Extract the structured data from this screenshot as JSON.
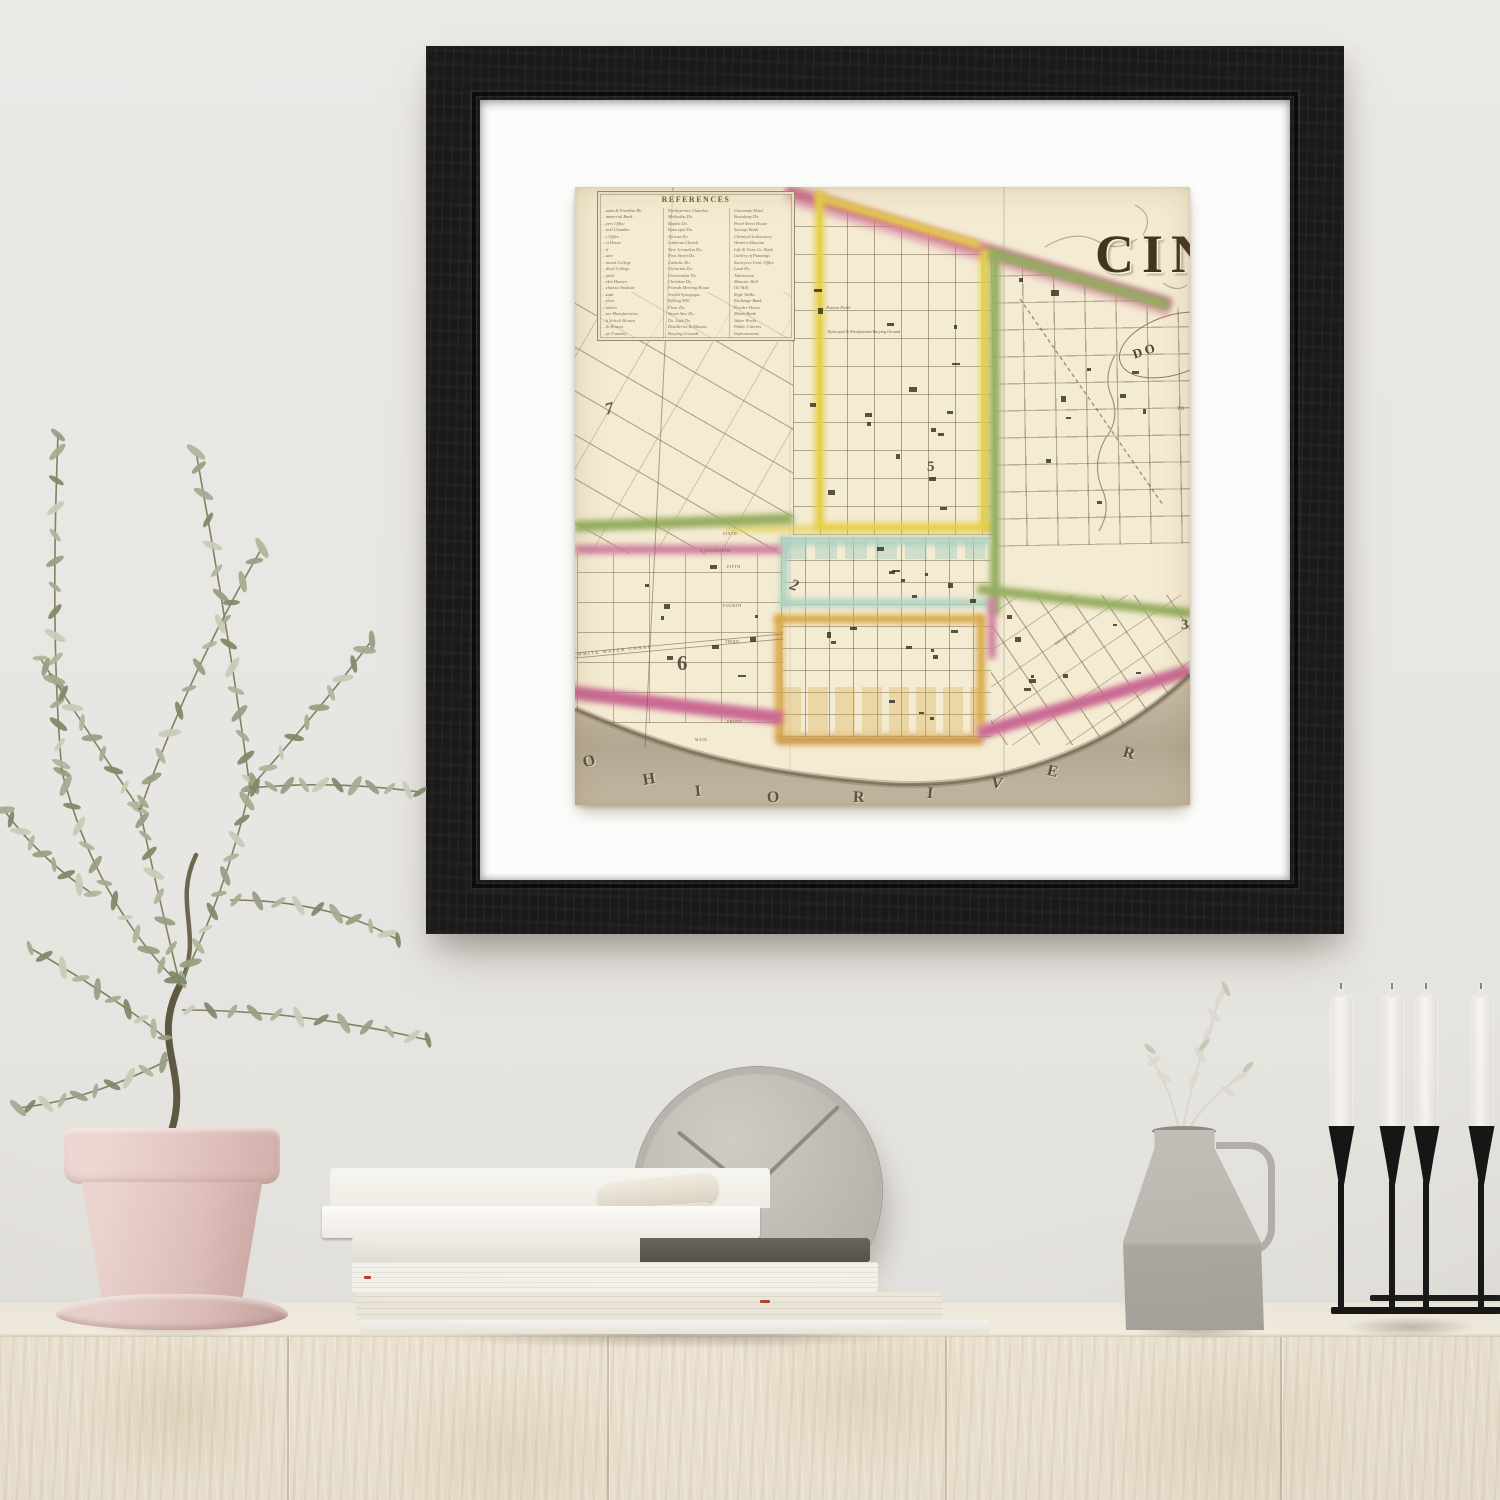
{
  "scene": {
    "objects": [
      "framed-map-print",
      "olive-plant-in-pot",
      "book-stack",
      "wall-clock",
      "jug-vase",
      "candle-stand",
      "wood-sideboard"
    ]
  },
  "artwork": {
    "title_partial": "CIN",
    "legend": {
      "title": "REFERENCES",
      "col1": [
        "…ands & Franklin Bk.",
        "…mmercial Bank",
        "…yers Office",
        "…ncil Chamber",
        "…t Office",
        "…rt House",
        "…il",
        "…atre",
        "…innati College",
        "…dical College",
        "…pital",
        "…rket Houses",
        "…chanics Institute",
        "…zaar",
        "…eries",
        "…ndries",
        "…ine Manufactories",
        "…h School Houses",
        "…th Houses",
        "…pe Foundry"
      ],
      "col2": [
        "Presbyterian Churches",
        "Methodist Do.",
        "Baptist Do.",
        "Episcopal Do.",
        "African Do.",
        "Lutheran Church",
        "New Jerusalem Do.",
        "First Street Do.",
        "Catholic Do.",
        "Unitarian Do.",
        "Universalist Do.",
        "Christian Do.",
        "Friends Meeting House",
        "Jewish Synagogue",
        "Rolling Mill",
        "Flour Do.",
        "Steam Saw Do.",
        "Do. Lath Do.",
        "Distilleries & Masons",
        "Burying Grounds"
      ],
      "col3": [
        "Cincinnati Hotel",
        "Broadway Do.",
        "Pearl Street House",
        "Savings Bank",
        "Chemical Laboratory",
        "Western Museum",
        "Life & Trust Co. Bank",
        "Gallery of Paintings",
        "Surveyors Genl. Office",
        "Land Do.",
        "Athenaeum",
        "Masonic Hall",
        "Oil Mill",
        "Rope Walks",
        "Exchange Bank",
        "Powder House",
        "Miami Bank",
        "Water Works",
        "Public Cisterns",
        "Improvements"
      ]
    },
    "river": [
      "O",
      "H",
      "I",
      "O",
      "R",
      "I",
      "V",
      "E",
      "R"
    ],
    "districts": [
      "7",
      "5",
      "2",
      "6",
      "3"
    ],
    "labels": {
      "potters_field": "Potters Field",
      "burying_ground": "Episcopal & Presbyterian Burying Ground",
      "canal": "WHITE WATER CANAL",
      "cartouche_partial": "DO",
      "edge_partial": "TO"
    },
    "streets": [
      "SIXTH",
      "LONGWORTH",
      "FIFTH",
      "FOURTH",
      "THIRD",
      "FRONT",
      "MAIN",
      "BROADWAY"
    ],
    "colors": {
      "paper": "#f4ebd3",
      "boundary_pink": "#cf6f95",
      "boundary_yellow": "#e5cf45",
      "boundary_green": "#95ad60",
      "district_teal": "#aed2c4",
      "district_orange": "#d8a844",
      "river_wash": "#b3a791",
      "frame": "#1d1c1a",
      "mat": "#fcfcfb",
      "wall": "#e8e6e2",
      "pot": "#e3c6c1",
      "sideboard_wood": "#ece3d2"
    }
  }
}
